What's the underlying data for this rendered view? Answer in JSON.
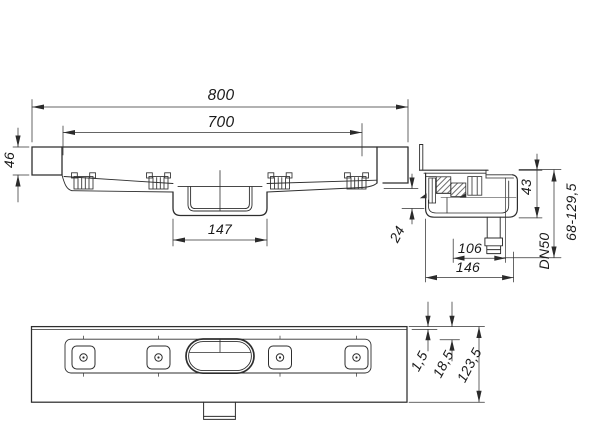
{
  "dims": {
    "total_length": "800",
    "grate_length": "700",
    "end_height": "46",
    "sump_length": "147",
    "sump_depth": "24",
    "body_height": "43",
    "installation_height": "68-129,5",
    "outlet_size": "DN50",
    "outlet_offset": "106",
    "body_depth": "146",
    "rim_offset": "1,5",
    "flange_offset": "18,5",
    "body_width": "123,5"
  }
}
